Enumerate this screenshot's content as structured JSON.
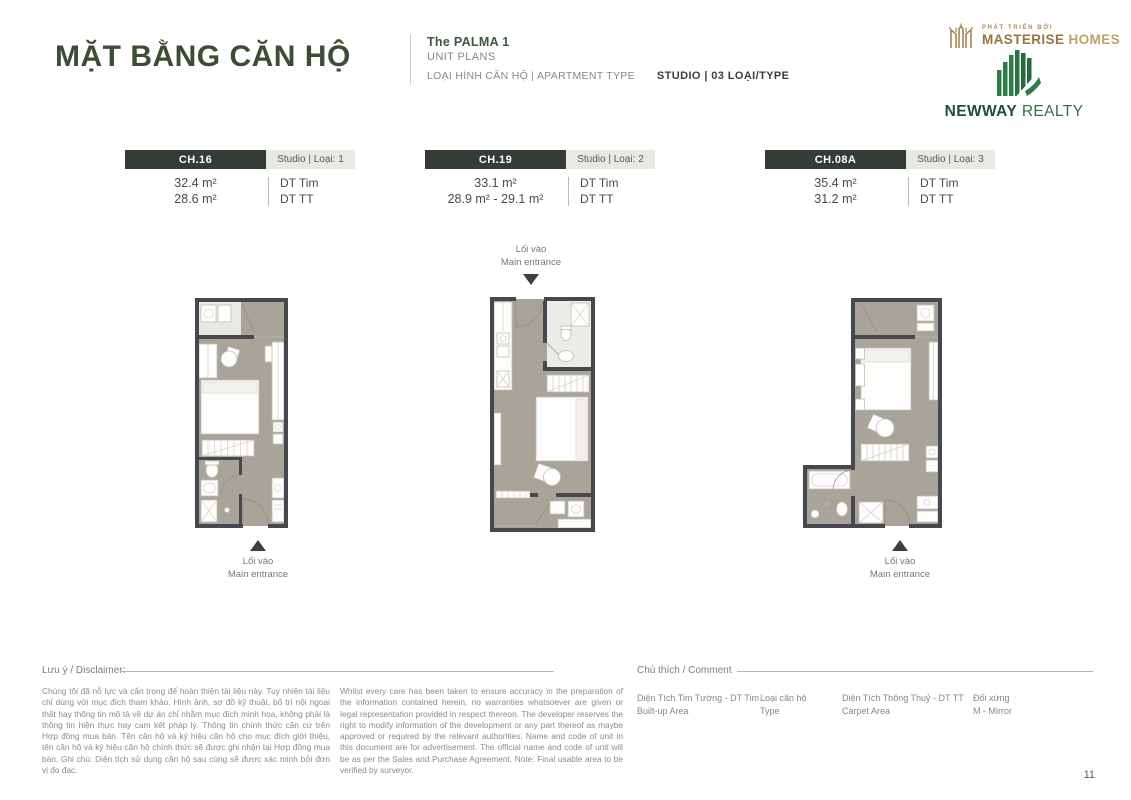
{
  "header": {
    "title": "MẶT BẰNG CĂN HỘ",
    "project_name": "The PALMA 1",
    "unit_plans": "UNIT PLANS",
    "type_label": "LOẠI HÌNH CĂN HỘ  |  APARTMENT TYPE",
    "type_value": "STUDIO  |  03 LOẠI/TYPE"
  },
  "logos": {
    "masterise_tagline": "PHÁT TRIỂN BỞI",
    "masterise_name": "MASTERISE",
    "masterise_suffix": "HOMES",
    "newway_name": "NEWWAY",
    "newway_suffix": "REALTY"
  },
  "units": [
    {
      "code": "CH.16",
      "type": "Studio | Loại: 1",
      "area_tim": "32.4 m²",
      "area_tt": "28.6 m²",
      "label_tim": "DT Tim",
      "label_tt": "DT TT",
      "entrance_vi": "Lối vào",
      "entrance_en": "Main entrance"
    },
    {
      "code": "CH.19",
      "type": "Studio | Loại: 2",
      "area_tim": "33.1 m²",
      "area_tt": "28.9 m² - 29.1 m²",
      "label_tim": "DT Tim",
      "label_tt": "DT TT",
      "entrance_vi": "Lối vào",
      "entrance_en": "Main entrance"
    },
    {
      "code": "CH.08A",
      "type": "Studio | Loại: 3",
      "area_tim": "35.4 m²",
      "area_tt": "31.2 m²",
      "label_tim": "DT Tim",
      "label_tt": "DT TT",
      "entrance_vi": "Lối vào",
      "entrance_en": "Main entrance"
    }
  ],
  "footer": {
    "disclaimer_label": "Lưu ý / Disclaimer:",
    "disclaimer_vi": "Chúng tôi đã nỗ lực và cẩn trọng để hoàn thiện tài liệu này. Tuy nhiên tài liệu chỉ dùng với mục đích tham khảo. Hình ảnh, sơ đồ kỹ thuật, bố trí nội ngoại thất hay thông tin mô tả về dự án chỉ nhằm mục đích minh họa, không phải là thông tin hiện thực hay cam kết pháp lý. Thông tin chính thức căn cứ trên Hợp đồng mua bán. Tên căn hộ và ký hiệu căn hộ cho mục đích giới thiệu, tên căn hộ và ký hiệu căn hộ chính thức sẽ được ghi nhận tại Hợp đồng mua bán. Ghi chú: Diện tích sử dụng căn hộ sau cùng sẽ được xác minh bởi đơn vị đo đạc.",
    "disclaimer_en": "Whilst every care has been taken to ensure accuracy in the preparation of the information contained herein, no warranties whatsoever are given or legal representation provided in respect thereon. The developer reserves the right to modify information of the development or any part thereof as maybe approved or required by the relevant authorities. Name and code of unit in this document are for advertisement. The official name and code of unit will be as per the Sales and Purchase Agreement. Note: Final usable area to be verified by surveyor.",
    "legend_label": "Chú thích / Comment",
    "legend": [
      {
        "line1": "Diện Tích Tim Tường - DT Tim",
        "line2": "Built-up Area"
      },
      {
        "line1": "Loại căn hộ",
        "line2": "Type"
      },
      {
        "line1": "Diện Tích Thông Thuỷ - DT TT",
        "line2": "Carpet Area"
      },
      {
        "line1": "Đối xứng",
        "line2": "M - Mirror"
      }
    ],
    "page_number": "11"
  },
  "colors": {
    "title_green": "#3b4d33",
    "unit_box_dark": "#333c35",
    "type_box_gray": "#e9e9e4",
    "wall_dark": "#45484c",
    "floor_taupe": "#a9a49a",
    "masterise_gold": "#a8854e",
    "newway_green": "#2e7c47",
    "text_gray": "#85888c"
  }
}
